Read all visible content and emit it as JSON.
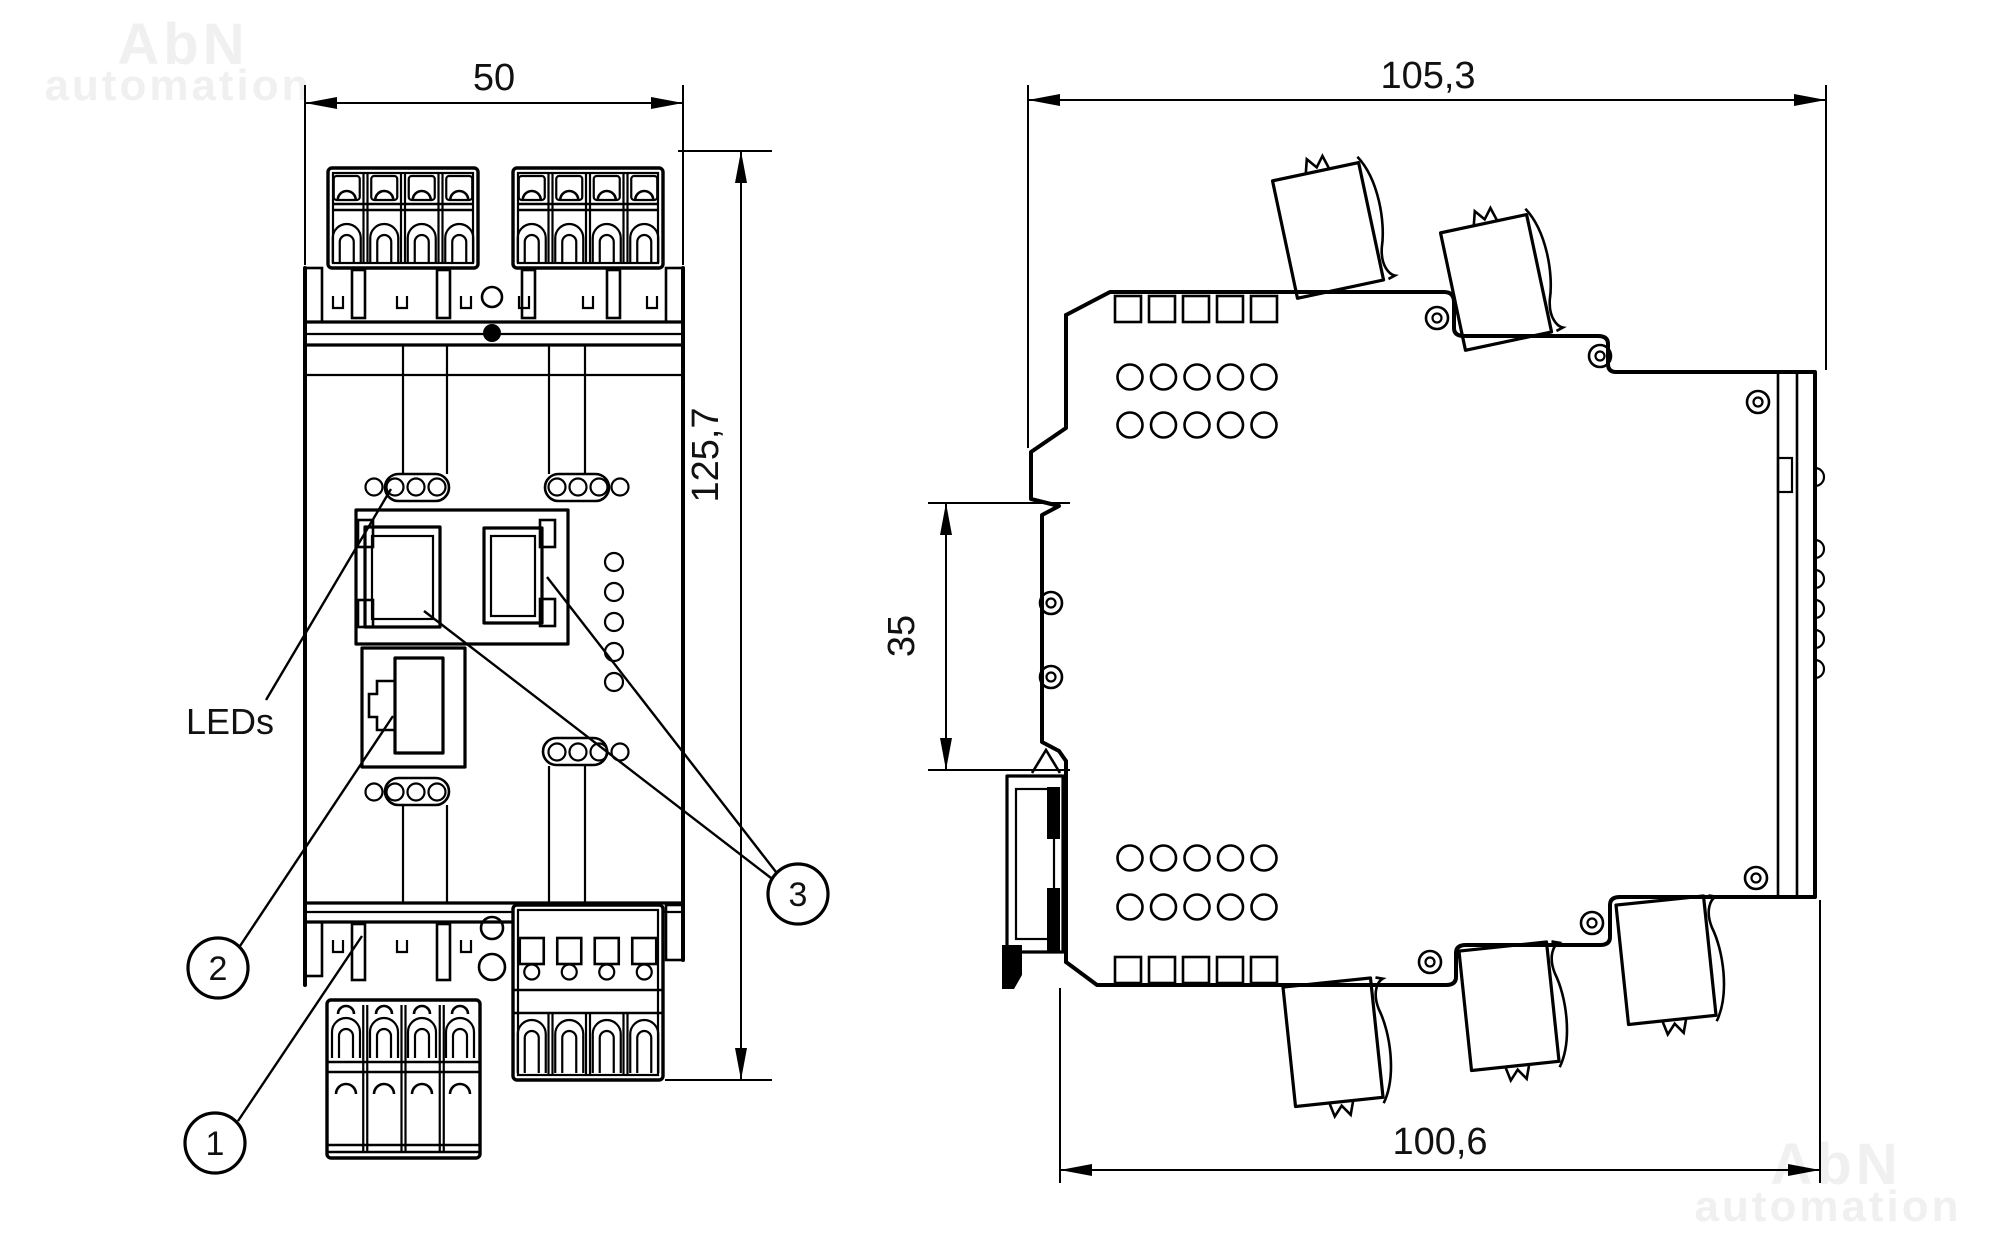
{
  "watermark": {
    "brand": "AbN",
    "word": "automation"
  },
  "colors": {
    "watermark": "#f0f0f0",
    "line": "#000000",
    "background": "#ffffff"
  },
  "front_view": {
    "dim_width": "50",
    "dim_height": "125,7",
    "led_label": "LEDs",
    "balloon_1": "1",
    "balloon_2": "2",
    "balloon_3": "3"
  },
  "side_view": {
    "dim_total_depth": "105,3",
    "dim_rail_height": "35",
    "dim_body_depth": "100,6"
  }
}
